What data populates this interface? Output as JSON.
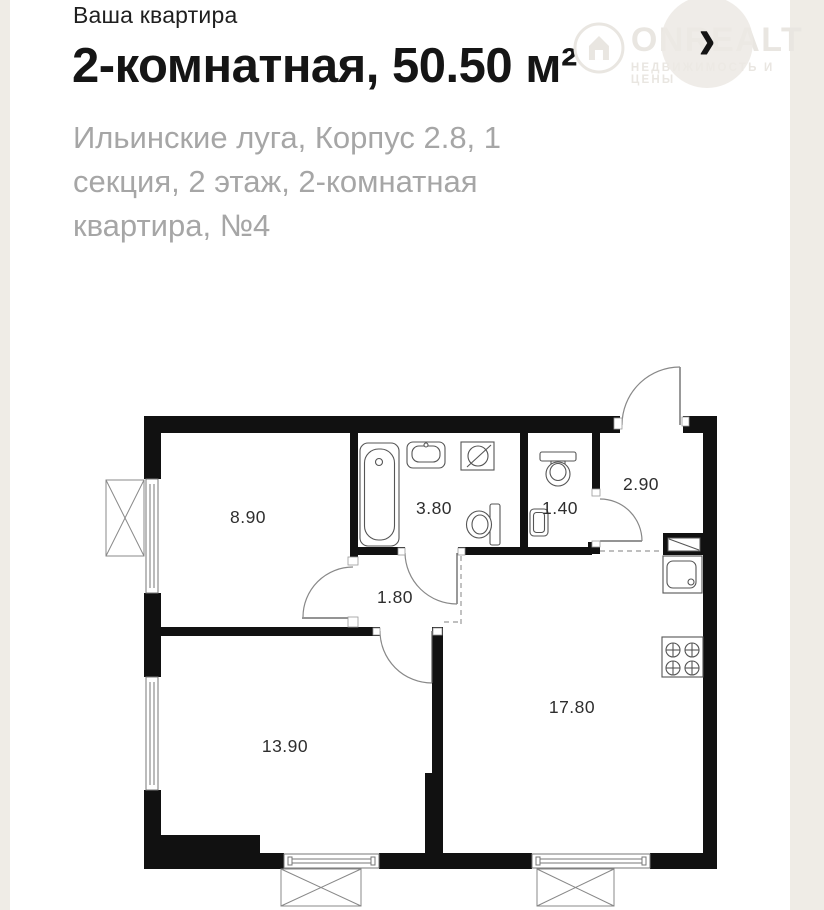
{
  "page": {
    "background": "#efece6",
    "card_background": "#ffffff"
  },
  "header": {
    "eyebrow": "Ваша квартира",
    "title": "2-комнатная, 50.50 м²",
    "subtitle": "Ильинские луга, Корпус 2.8, 1 секция, 2 этаж, 2-комнатная квартира, №4"
  },
  "nav": {
    "chevron": "›"
  },
  "watermark": {
    "brand": "ONREALT",
    "tagline": "НЕДВИЖИМОСТЬ И ЦЕНЫ",
    "logo_icon": "house-in-circle-icon",
    "color": "#e9e6e1"
  },
  "plan": {
    "wall_color": "#111111",
    "rooms": [
      {
        "id": "room-top-left",
        "area": "8.90"
      },
      {
        "id": "bathroom",
        "area": "3.80"
      },
      {
        "id": "wc",
        "area": "1.40"
      },
      {
        "id": "hallway",
        "area": "2.90"
      },
      {
        "id": "corridor",
        "area": "1.80"
      },
      {
        "id": "room-bottom-left",
        "area": "13.90"
      },
      {
        "id": "kitchen-living",
        "area": "17.80"
      }
    ],
    "fixture_icons": [
      "bathtub-icon",
      "sink-icon",
      "washing-machine-icon",
      "toilet-icon",
      "wc-toilet-icon",
      "wc-sink-icon",
      "vent-shaft-icon",
      "kitchen-sink-icon",
      "stove-icon"
    ]
  }
}
